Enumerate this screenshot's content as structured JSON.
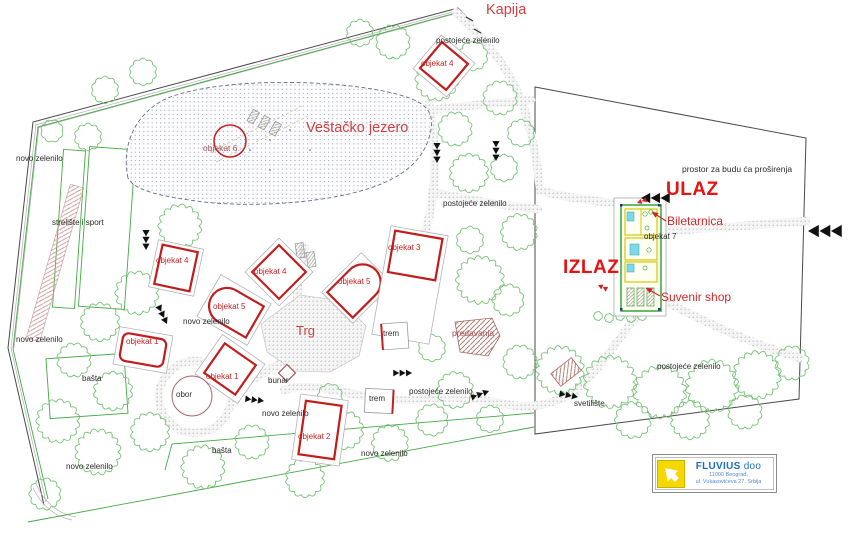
{
  "map": {
    "colors": {
      "cad_red": "#c22020",
      "accent_red": "#e31414",
      "tree_green": "#76c276",
      "boundary_green": "#44a944",
      "path_gray": "#bdbdbd",
      "lake_dot": "#9095b5",
      "hatch_brown": "#aa6666",
      "logo_yellow": "#f5d800",
      "logo_blue": "#1a6fc4"
    },
    "labels": [
      {
        "id": "kapija",
        "text": "Kapija",
        "x": 486,
        "y": 3,
        "cls": "red-lg"
      },
      {
        "id": "postojece-zelenilo-top",
        "text": "postojeće zelenilo",
        "x": 436,
        "y": 37,
        "cls": "blk-sm"
      },
      {
        "id": "objekat-4-north",
        "text": "objekat 4",
        "x": 421,
        "y": 60,
        "cls": "red-sm"
      },
      {
        "id": "vestacko-jezero",
        "text": "Veštačko jezero",
        "x": 306,
        "y": 121,
        "cls": "red-lg"
      },
      {
        "id": "objekat-6",
        "text": "objekat 6",
        "x": 203,
        "y": 144,
        "cls": "red-dk"
      },
      {
        "id": "novo-zelenilo-topleft",
        "text": "novo zelenilo",
        "x": 16,
        "y": 155,
        "cls": "blk-sm"
      },
      {
        "id": "prostor-za-prosirenja",
        "text": "prostor za budu ća proširenja",
        "x": 682,
        "y": 165,
        "cls": "blk-md"
      },
      {
        "id": "ulaz",
        "text": "ULAZ",
        "x": 666,
        "y": 180,
        "cls": "red-xl"
      },
      {
        "id": "postojece-zelenilo-mid",
        "text": "postojeće zelenilo",
        "x": 443,
        "y": 200,
        "cls": "blk-sm"
      },
      {
        "id": "biletarnica",
        "text": "Biletarnica",
        "x": 667,
        "y": 215,
        "cls": "red-md"
      },
      {
        "id": "streliste-i-sport",
        "text": "strelište i sport",
        "x": 52,
        "y": 219,
        "cls": "blk-sm"
      },
      {
        "id": "objekat-7",
        "text": "objekat 7",
        "x": 644,
        "y": 233,
        "cls": "blk-sm"
      },
      {
        "id": "objekat-3",
        "text": "objekat 3",
        "x": 388,
        "y": 244,
        "cls": "red-sm"
      },
      {
        "id": "objekat-4-west",
        "text": "objekat 4",
        "x": 156,
        "y": 257,
        "cls": "red-sm"
      },
      {
        "id": "izlaz",
        "text": "IZLAZ",
        "x": 563,
        "y": 258,
        "cls": "red-xl"
      },
      {
        "id": "objekat-4-central",
        "text": "objekat 4",
        "x": 254,
        "y": 268,
        "cls": "red-sm"
      },
      {
        "id": "objekat-5-east",
        "text": "objekat 5",
        "x": 338,
        "y": 278,
        "cls": "red-sm"
      },
      {
        "id": "suvenir-shop",
        "text": "Suvenir shop",
        "x": 661,
        "y": 291,
        "cls": "red-md"
      },
      {
        "id": "objekat-5-west",
        "text": "objekat 5",
        "x": 213,
        "y": 303,
        "cls": "red-sm"
      },
      {
        "id": "novo-zelenilo-mid",
        "text": "novo zelenilo",
        "x": 183,
        "y": 318,
        "cls": "blk-sm"
      },
      {
        "id": "trg",
        "text": "Trg",
        "x": 296,
        "y": 324,
        "cls": "red-trg"
      },
      {
        "id": "predavanja",
        "text": "predavanja",
        "x": 452,
        "y": 329,
        "cls": "red-dk"
      },
      {
        "id": "trem-north",
        "text": "trem",
        "x": 383,
        "y": 330,
        "cls": "blk-sm"
      },
      {
        "id": "novo-zelenilo-west",
        "text": "novo zelenilo",
        "x": 16,
        "y": 336,
        "cls": "blk-sm"
      },
      {
        "id": "objekat-1-west",
        "text": "objekat 1",
        "x": 126,
        "y": 338,
        "cls": "red-sm"
      },
      {
        "id": "postojece-zelenilo-east",
        "text": "postojeće zelenilo",
        "x": 657,
        "y": 363,
        "cls": "blk-sm"
      },
      {
        "id": "objekat-1-central",
        "text": "objekat 1",
        "x": 206,
        "y": 373,
        "cls": "red-sm"
      },
      {
        "id": "basta-west",
        "text": "bašta",
        "x": 82,
        "y": 375,
        "cls": "blk-sm"
      },
      {
        "id": "bunar",
        "text": "bunar",
        "x": 268,
        "y": 377,
        "cls": "blk-sm"
      },
      {
        "id": "postojece-zelenilo-south",
        "text": "postojeće zelenilo",
        "x": 409,
        "y": 388,
        "cls": "blk-sm"
      },
      {
        "id": "obor",
        "text": "obor",
        "x": 176,
        "y": 391,
        "cls": "blk-sm"
      },
      {
        "id": "trem-south",
        "text": "trem",
        "x": 369,
        "y": 395,
        "cls": "blk-sm"
      },
      {
        "id": "svetiliste",
        "text": "svetilište",
        "x": 574,
        "y": 400,
        "cls": "blk-sm"
      },
      {
        "id": "novo-zelenilo-central",
        "text": "novo zelenilo",
        "x": 262,
        "y": 410,
        "cls": "blk-sm"
      },
      {
        "id": "objekat-2",
        "text": "objekat 2",
        "x": 298,
        "y": 433,
        "cls": "red-sm"
      },
      {
        "id": "basta-south",
        "text": "bašta",
        "x": 212,
        "y": 447,
        "cls": "blk-sm"
      },
      {
        "id": "novo-zelenilo-south",
        "text": "novo zelenilo",
        "x": 361,
        "y": 450,
        "cls": "blk-sm"
      },
      {
        "id": "novo-zelenilo-southwest",
        "text": "novo zelenilo",
        "x": 66,
        "y": 463,
        "cls": "blk-sm"
      }
    ],
    "arrows": [
      {
        "x": 641,
        "y": 198,
        "rot": 0,
        "s": 1.15,
        "c": "#111111",
        "n": 3
      },
      {
        "x": 808,
        "y": 231,
        "rot": 0,
        "s": 1.35,
        "c": "#111111",
        "n": 3
      },
      {
        "x": 437,
        "y": 163,
        "rot": -90,
        "s": 0.8,
        "c": "#111111",
        "n": 3
      },
      {
        "x": 496,
        "y": 161,
        "rot": -90,
        "s": 0.8,
        "c": "#111111",
        "n": 3
      },
      {
        "x": 146,
        "y": 250,
        "rot": -90,
        "s": 0.8,
        "c": "#111111",
        "n": 3
      },
      {
        "x": 167,
        "y": 324,
        "rot": -115,
        "s": 0.8,
        "c": "#111111",
        "n": 3
      },
      {
        "x": 264,
        "y": 401,
        "rot": 187,
        "s": 0.75,
        "c": "#111111",
        "n": 3
      },
      {
        "x": 412,
        "y": 373,
        "rot": 180,
        "s": 0.75,
        "c": "#111111",
        "n": 3
      },
      {
        "x": 489,
        "y": 391,
        "rot": 160,
        "s": 0.75,
        "c": "#111111",
        "n": 3
      },
      {
        "x": 578,
        "y": 397,
        "rot": 190,
        "s": 0.75,
        "c": "#111111",
        "n": 3
      },
      {
        "x": 637,
        "y": 203,
        "rot": -20,
        "s": 0.6,
        "c": "#d22222",
        "n": 2
      },
      {
        "x": 598,
        "y": 285,
        "rot": 25,
        "s": 0.6,
        "c": "#d22222",
        "n": 2
      }
    ],
    "trees": [
      [
        393,
        42,
        15
      ],
      [
        437,
        79,
        19
      ],
      [
        473,
        56,
        13
      ],
      [
        360,
        33,
        12
      ],
      [
        500,
        98,
        15
      ],
      [
        521,
        133,
        12
      ],
      [
        455,
        129,
        15
      ],
      [
        469,
        173,
        17
      ],
      [
        504,
        168,
        12
      ],
      [
        105,
        90,
        12
      ],
      [
        143,
        72,
        12
      ],
      [
        52,
        131,
        10
      ],
      [
        88,
        137,
        12
      ],
      [
        180,
        226,
        19
      ],
      [
        137,
        293,
        19
      ],
      [
        100,
        322,
        17
      ],
      [
        74,
        360,
        15
      ],
      [
        113,
        391,
        17
      ],
      [
        58,
        421,
        19
      ],
      [
        98,
        452,
        20
      ],
      [
        45,
        494,
        14
      ],
      [
        150,
        432,
        17
      ],
      [
        203,
        467,
        19
      ],
      [
        252,
        442,
        15
      ],
      [
        305,
        478,
        17
      ],
      [
        344,
        430,
        17
      ],
      [
        390,
        443,
        16
      ],
      [
        432,
        420,
        14
      ],
      [
        330,
        396,
        11
      ],
      [
        228,
        352,
        10
      ],
      [
        455,
        390,
        16
      ],
      [
        490,
        419,
        12
      ],
      [
        520,
        362,
        15
      ],
      [
        480,
        280,
        21
      ],
      [
        519,
        232,
        16
      ],
      [
        470,
        240,
        12
      ],
      [
        508,
        300,
        14
      ],
      [
        432,
        348,
        12
      ],
      [
        560,
        370,
        21
      ],
      [
        610,
        382,
        23
      ],
      [
        660,
        392,
        23
      ],
      [
        712,
        386,
        23
      ],
      [
        757,
        375,
        21
      ],
      [
        792,
        363,
        15
      ],
      [
        633,
        420,
        16
      ],
      [
        690,
        420,
        17
      ],
      [
        745,
        412,
        15
      ],
      [
        598,
        316,
        4
      ],
      [
        609,
        318,
        4
      ],
      [
        620,
        316,
        4
      ],
      [
        631,
        318,
        4
      ],
      [
        642,
        316,
        4
      ]
    ]
  },
  "legend": {
    "company": "FLUVIUS",
    "suffix": "doo",
    "address1": "11000 Beograd,",
    "address2": "ul. Vukasovićeva 27, Srbija"
  }
}
